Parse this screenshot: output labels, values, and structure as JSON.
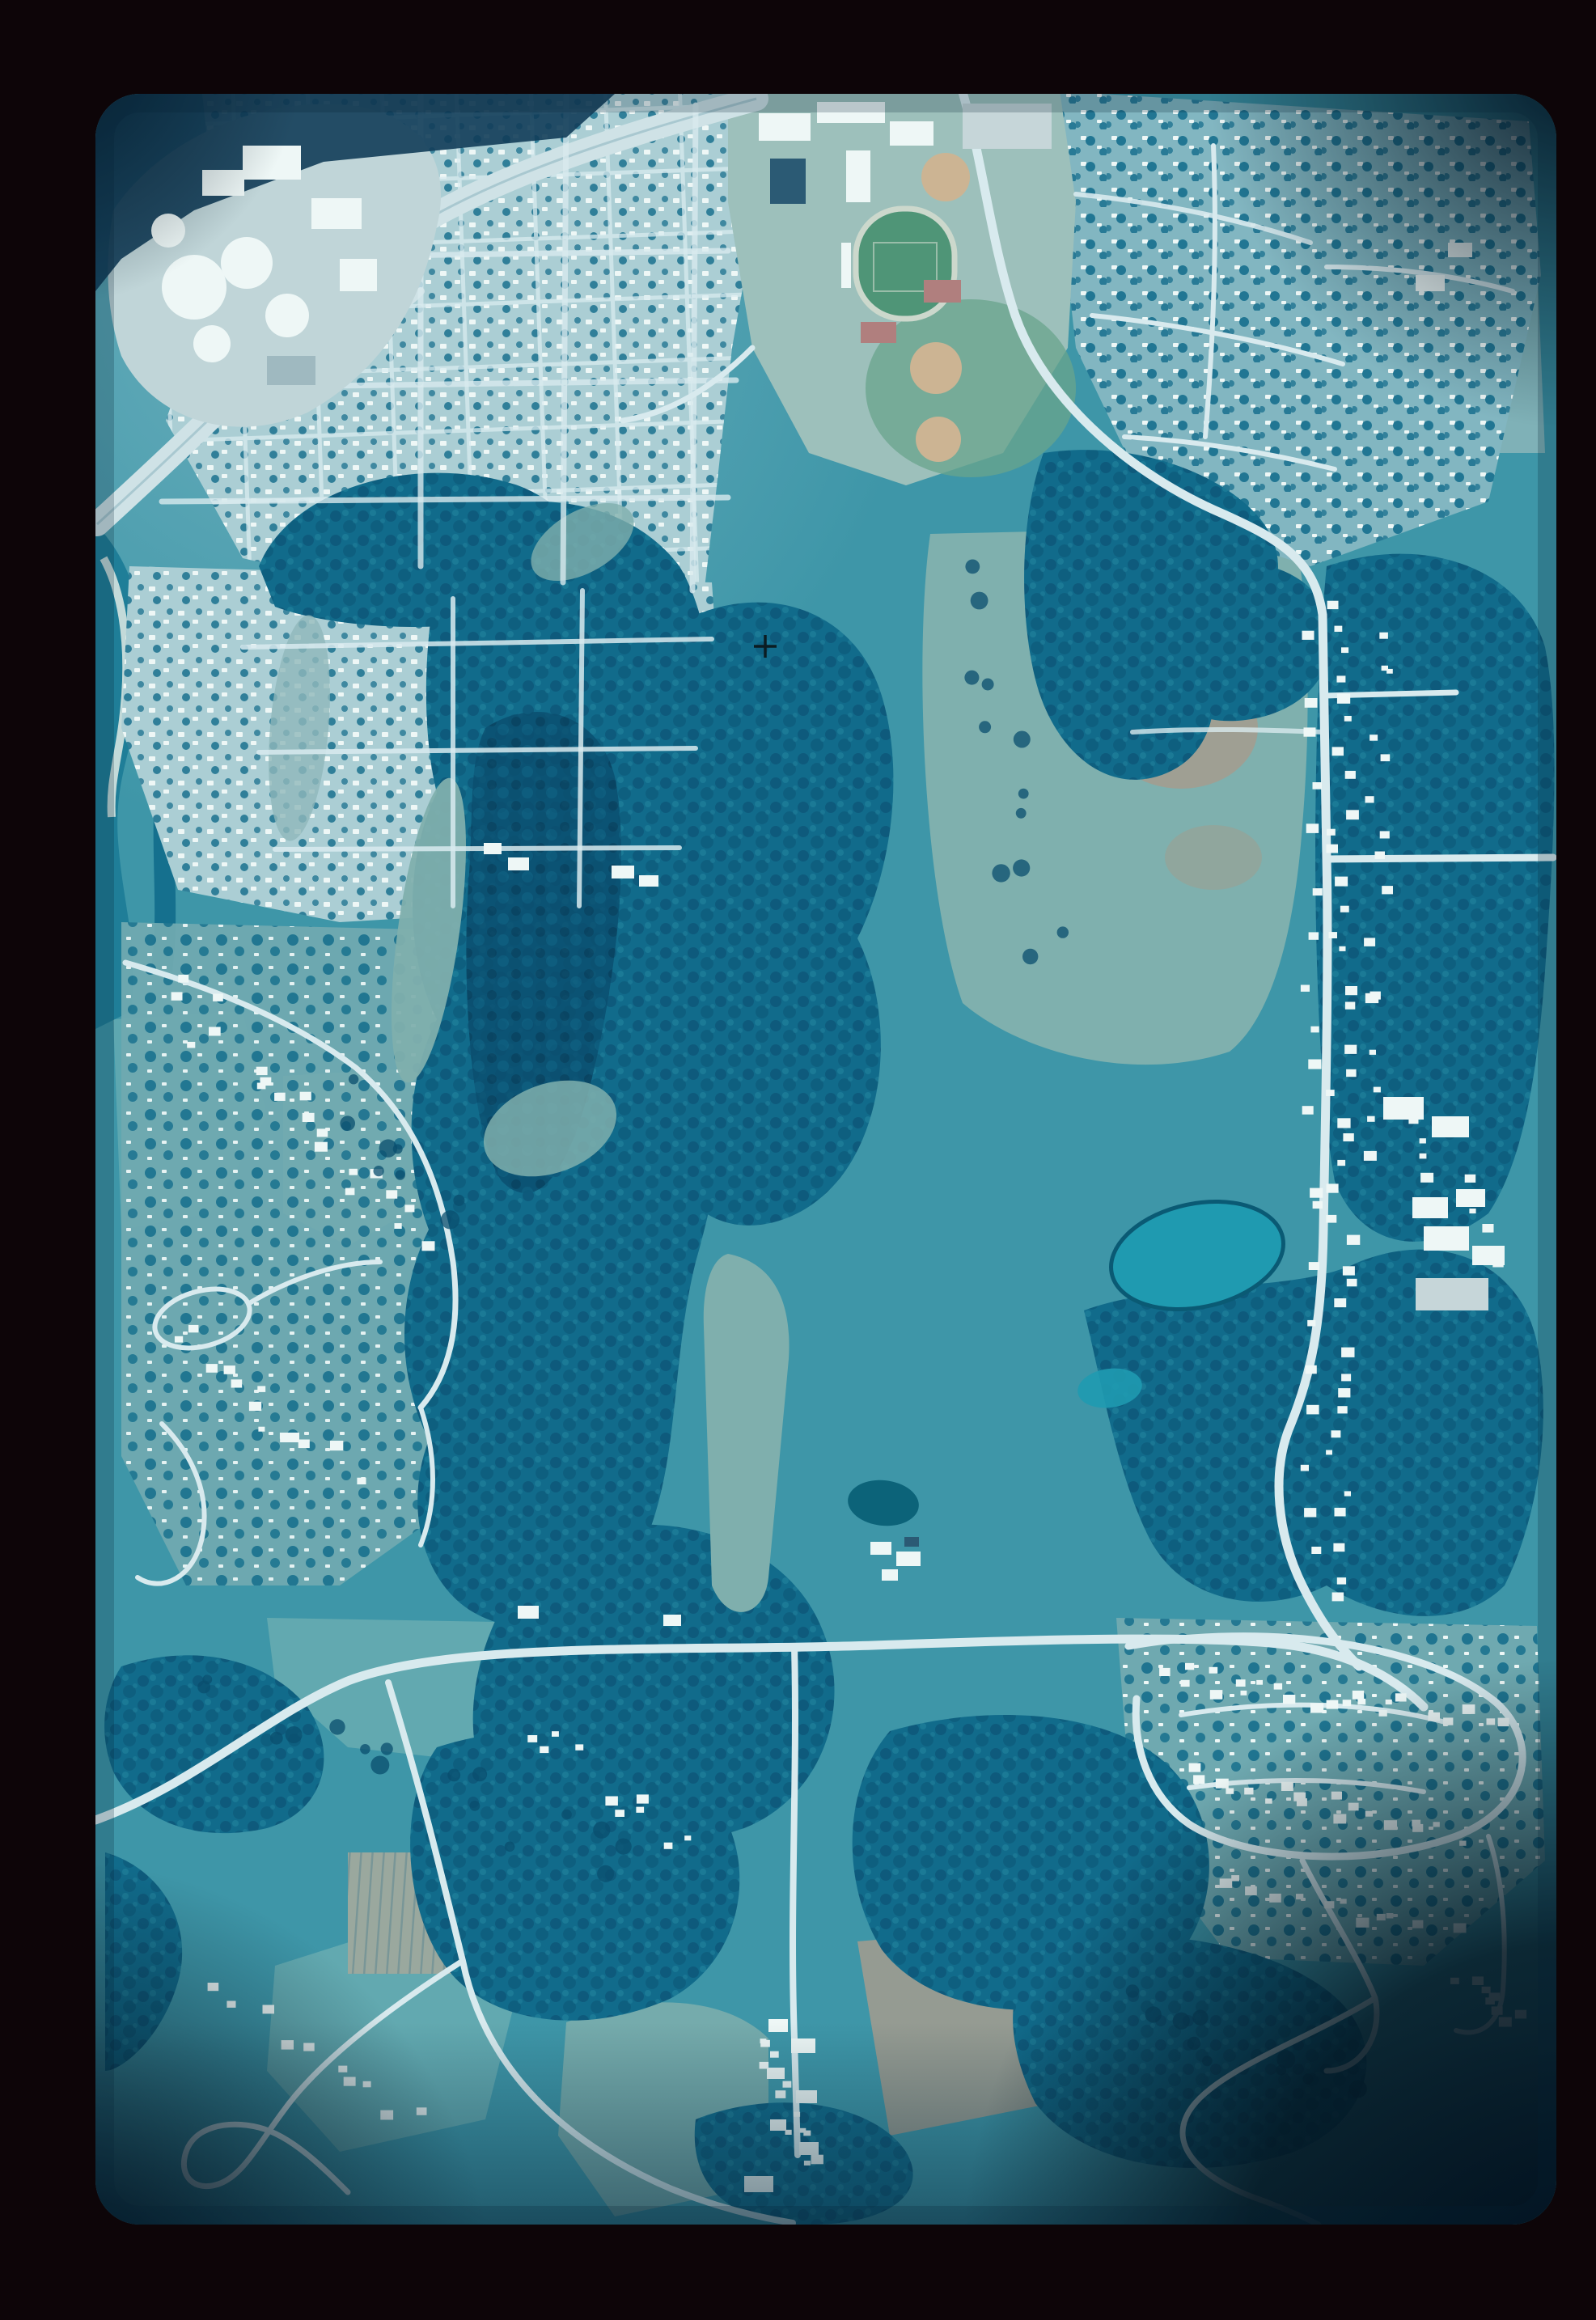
{
  "image": {
    "kind": "aerial-photograph-film-slide",
    "orientation": "portrait",
    "visible_text": "none"
  },
  "palette": {
    "mount": "#0d0508",
    "photo_base": "#3e96a8",
    "haze": "#d9ecee",
    "forest": "#116b8b",
    "forest_deep": "#0a4d6e",
    "forest_hi": "#2f94ab",
    "river": "#1f7e98",
    "sand": "#d3e3de",
    "freeway": "#cfe2e6",
    "road": "#d8eaee",
    "house_white": "#eef7f6",
    "resi_base": "#abced4",
    "resi_ne": "#82b6c1",
    "suburb_base": "#6fa9b0",
    "field_gray": "#7fafad",
    "field_pale": "#90b8ba",
    "field_teal": "#62a9b0",
    "field_tan": "#a59c8e",
    "meadow": "#7fb0ae",
    "pond": "#1f9ab0",
    "pond_dark": "#0c6379",
    "track_green": "#4f9577",
    "track_lane": "#ccd8cc",
    "diamond_tan": "#ccb493",
    "tennis_red": "#b07f7e",
    "campus_ground": "#9dc0bb",
    "industrial_ground": "#c0d5d8",
    "dark_band": "#123d59",
    "building_dark": "#2b5a74",
    "parking": "#c6d6d9",
    "orchard": "#9aa89e",
    "orchard_line": "#6b8f94",
    "vignette": "#03141f",
    "cross": "#0b1c22"
  },
  "scene": {
    "regions": [
      {
        "name": "slide-mount",
        "fill": "mount"
      },
      {
        "name": "industrial-plant",
        "fill": "industrial_ground"
      },
      {
        "name": "freeway-interchange",
        "fill": "freeway"
      },
      {
        "name": "residential-grid-northwest",
        "fill": "resi_base"
      },
      {
        "name": "residential-northeast",
        "fill": "resi_ne"
      },
      {
        "name": "school-campus",
        "fill": "campus_ground"
      },
      {
        "name": "stadium-track",
        "fill": "track_green"
      },
      {
        "name": "baseball-diamonds",
        "fill": "diamond_tan"
      },
      {
        "name": "tennis-courts",
        "fill": "tennis_red"
      },
      {
        "name": "river",
        "fill": "river"
      },
      {
        "name": "wooded-ravines",
        "fill": "forest"
      },
      {
        "name": "meadow",
        "fill": "meadow"
      },
      {
        "name": "farm-pond",
        "fill": "pond"
      },
      {
        "name": "orchard-rows",
        "fill": "orchard"
      },
      {
        "name": "subdivision-southeast",
        "fill": "suburb_base"
      },
      {
        "name": "settlement-south",
        "fill": "house_white"
      },
      {
        "name": "registration-cross",
        "fill": "cross"
      },
      {
        "name": "corner-vignette",
        "fill": "vignette"
      }
    ]
  }
}
